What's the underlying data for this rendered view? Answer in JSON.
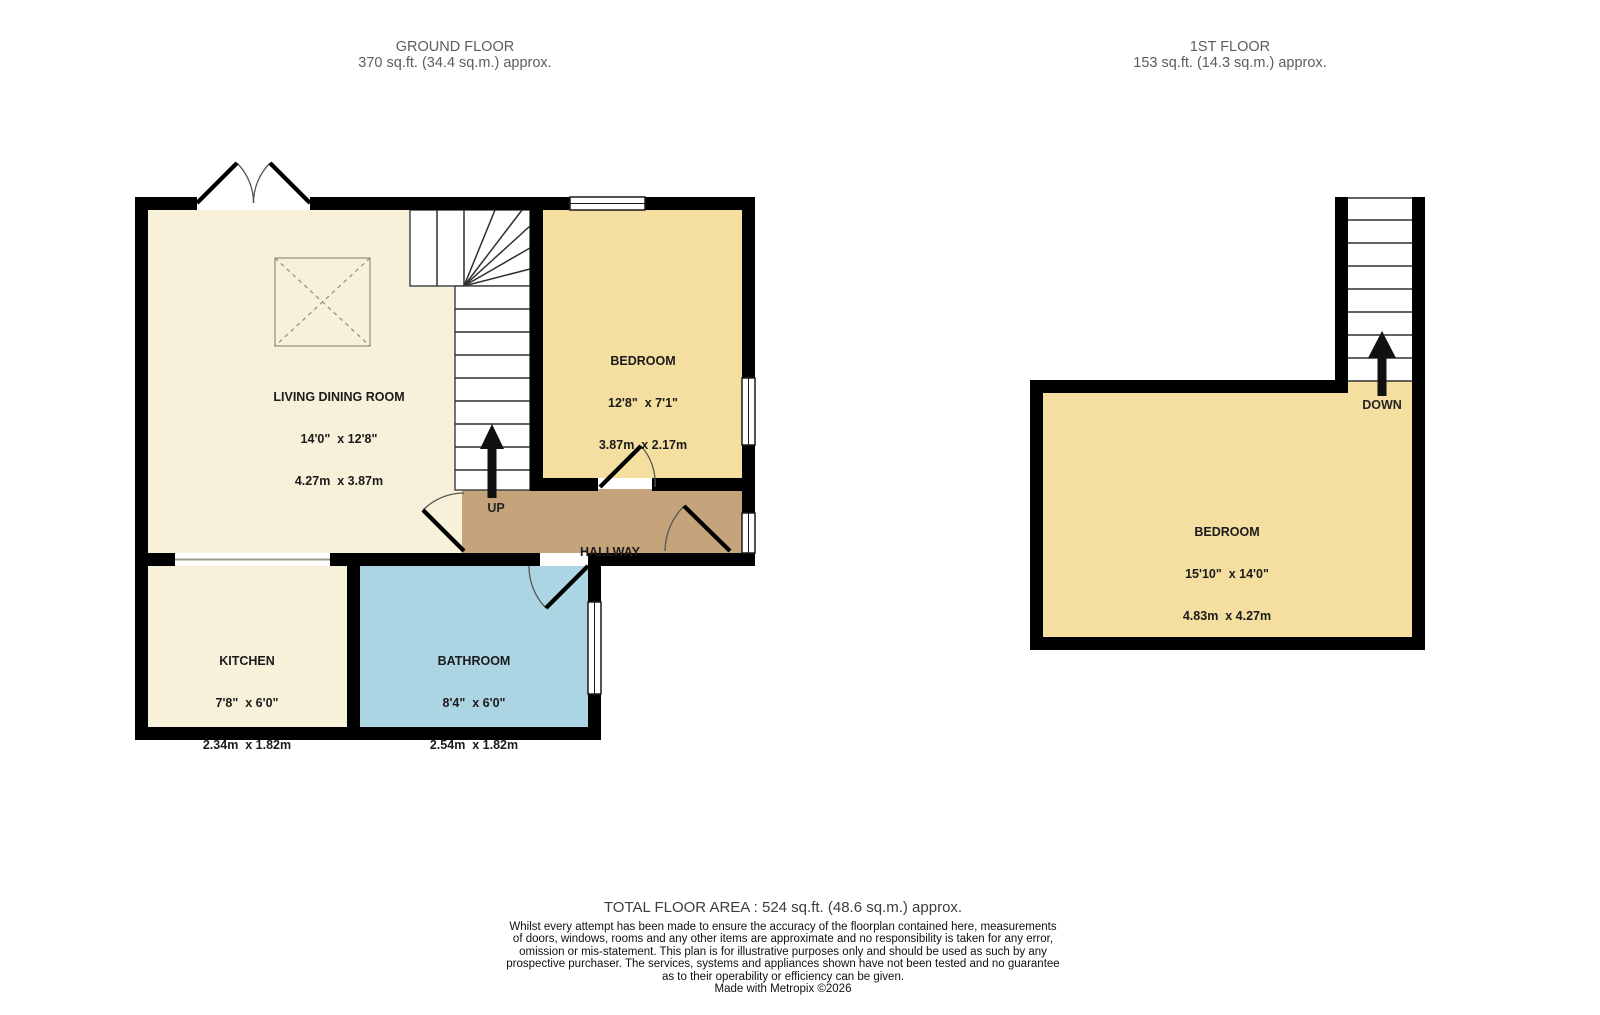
{
  "colors": {
    "wall": "#000000",
    "cream": "#f7f1d9",
    "yellow": "#f4dfa0",
    "tan": "#c5a47c",
    "blue": "#abd5e2"
  },
  "ground_floor": {
    "title": "GROUND FLOOR",
    "subtitle": "370 sq.ft. (34.4 sq.m.) approx.",
    "stairs_label": "UP",
    "rooms": {
      "living_dining": {
        "name": "LIVING DINING ROOM",
        "imperial": "14'0\"  x 12'8\"",
        "metric": "4.27m  x 3.87m"
      },
      "bedroom": {
        "name": "BEDROOM",
        "imperial": "12'8\"  x 7'1\"",
        "metric": "3.87m  x 2.17m"
      },
      "kitchen": {
        "name": "KITCHEN",
        "imperial": "7'8\"  x 6'0\"",
        "metric": "2.34m  x 1.82m"
      },
      "bathroom": {
        "name": "BATHROOM",
        "imperial": "8'4\"  x 6'0\"",
        "metric": "2.54m  x 1.82m"
      },
      "hallway": {
        "name": "HALLWAY"
      }
    }
  },
  "first_floor": {
    "title": "1ST FLOOR",
    "subtitle": "153 sq.ft. (14.3 sq.m.) approx.",
    "stairs_label": "DOWN",
    "rooms": {
      "bedroom": {
        "name": "BEDROOM",
        "imperial": "15'10\"  x 14'0\"",
        "metric": "4.83m  x 4.27m"
      }
    }
  },
  "footer": {
    "total_area": "TOTAL FLOOR AREA : 524 sq.ft. (48.6 sq.m.) approx.",
    "disclaimer": [
      "Whilst every attempt has been made to ensure the accuracy of the floorplan contained here, measurements",
      "of doors, windows, rooms and any other items are approximate and no responsibility is taken for any error,",
      "omission or mis-statement. This plan is for illustrative purposes only and should be used as such by any",
      "prospective purchaser. The services, systems and appliances shown have not been tested and no guarantee",
      "as to their operability or efficiency can be given."
    ],
    "credit": "Made with Metropix ©2026"
  }
}
